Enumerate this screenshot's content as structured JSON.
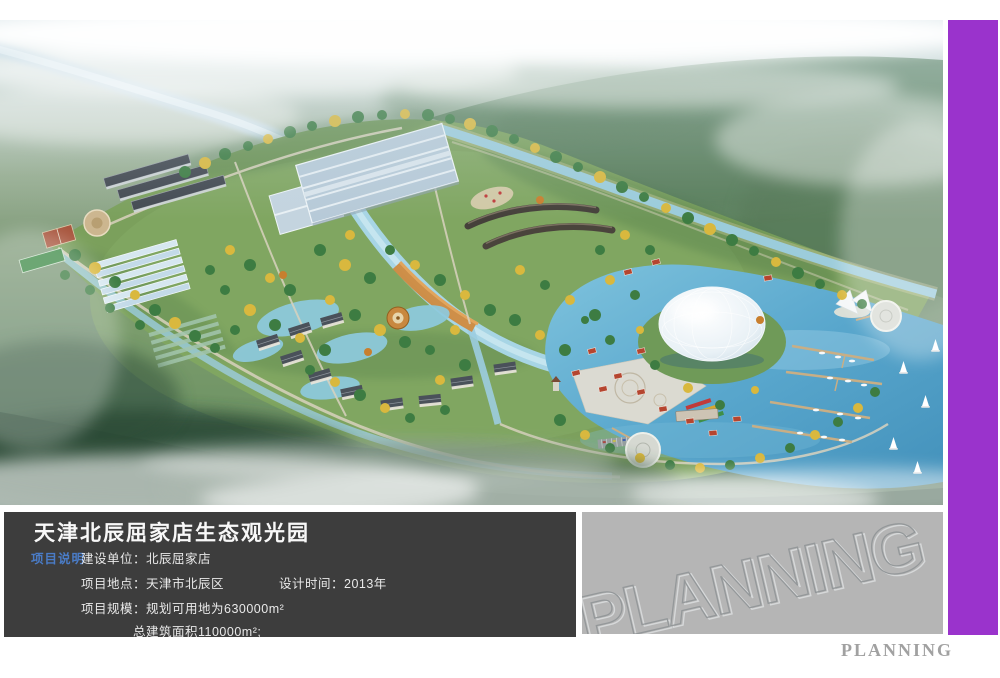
{
  "info_panel": {
    "title": "天津北辰屈家店生态观光园",
    "section_label": "项目说明",
    "construction_unit": "建设单位：北辰屈家店",
    "location": "项目地点：天津市北辰区",
    "design_time": "设计时间：2013年",
    "scale": "项目规模：规划可用地为630000m²",
    "total_area": "总建筑面积110000m²;"
  },
  "watermark": {
    "text": "PLANNING"
  },
  "footer": {
    "brand": "PLANNING"
  },
  "colors": {
    "accent_purple": "#9a33cc",
    "panel_dark": "#3d3d3d",
    "panel_gray": "#b5b5b5",
    "label_blue": "#4a7cc7",
    "title_white": "#f8f8f8",
    "footer_gray": "#a1a1a1"
  },
  "scene": {
    "type": "aerial-architectural-rendering",
    "features": [
      "winding-river",
      "misty-fields",
      "outer-forest",
      "glass-exhibition-hall",
      "dormitory-rows",
      "greenhouse-rows",
      "circular-plaza",
      "sports-courts",
      "central-canal",
      "orange-boardwalk",
      "lagoon-ponds",
      "chinese-roof-cottages",
      "round-pavilion",
      "white-plaza",
      "flower-beds",
      "parking-lot",
      "lake",
      "dome-greenhouse",
      "island-cottages",
      "piers-with-boats",
      "round-platforms",
      "sail-canopy",
      "sailboats",
      "bottom-mist"
    ],
    "palette": {
      "fog": "#f4f6f4",
      "field_green": "#7e9a79",
      "park_green": "#7ba05c",
      "forest_green": "#4d724f",
      "lake_blue": "#59a7cd",
      "canal_blue": "#a7d5e5",
      "dome_white": "#e9f1f6",
      "dark_roof": "#4a515a",
      "red_roof": "#b5452f",
      "boardwalk_orange": "#cf8a3f",
      "road_tan": "#d9d2be",
      "tree_green": "#3d7c42",
      "tree_yellow": "#d9b83e"
    }
  }
}
